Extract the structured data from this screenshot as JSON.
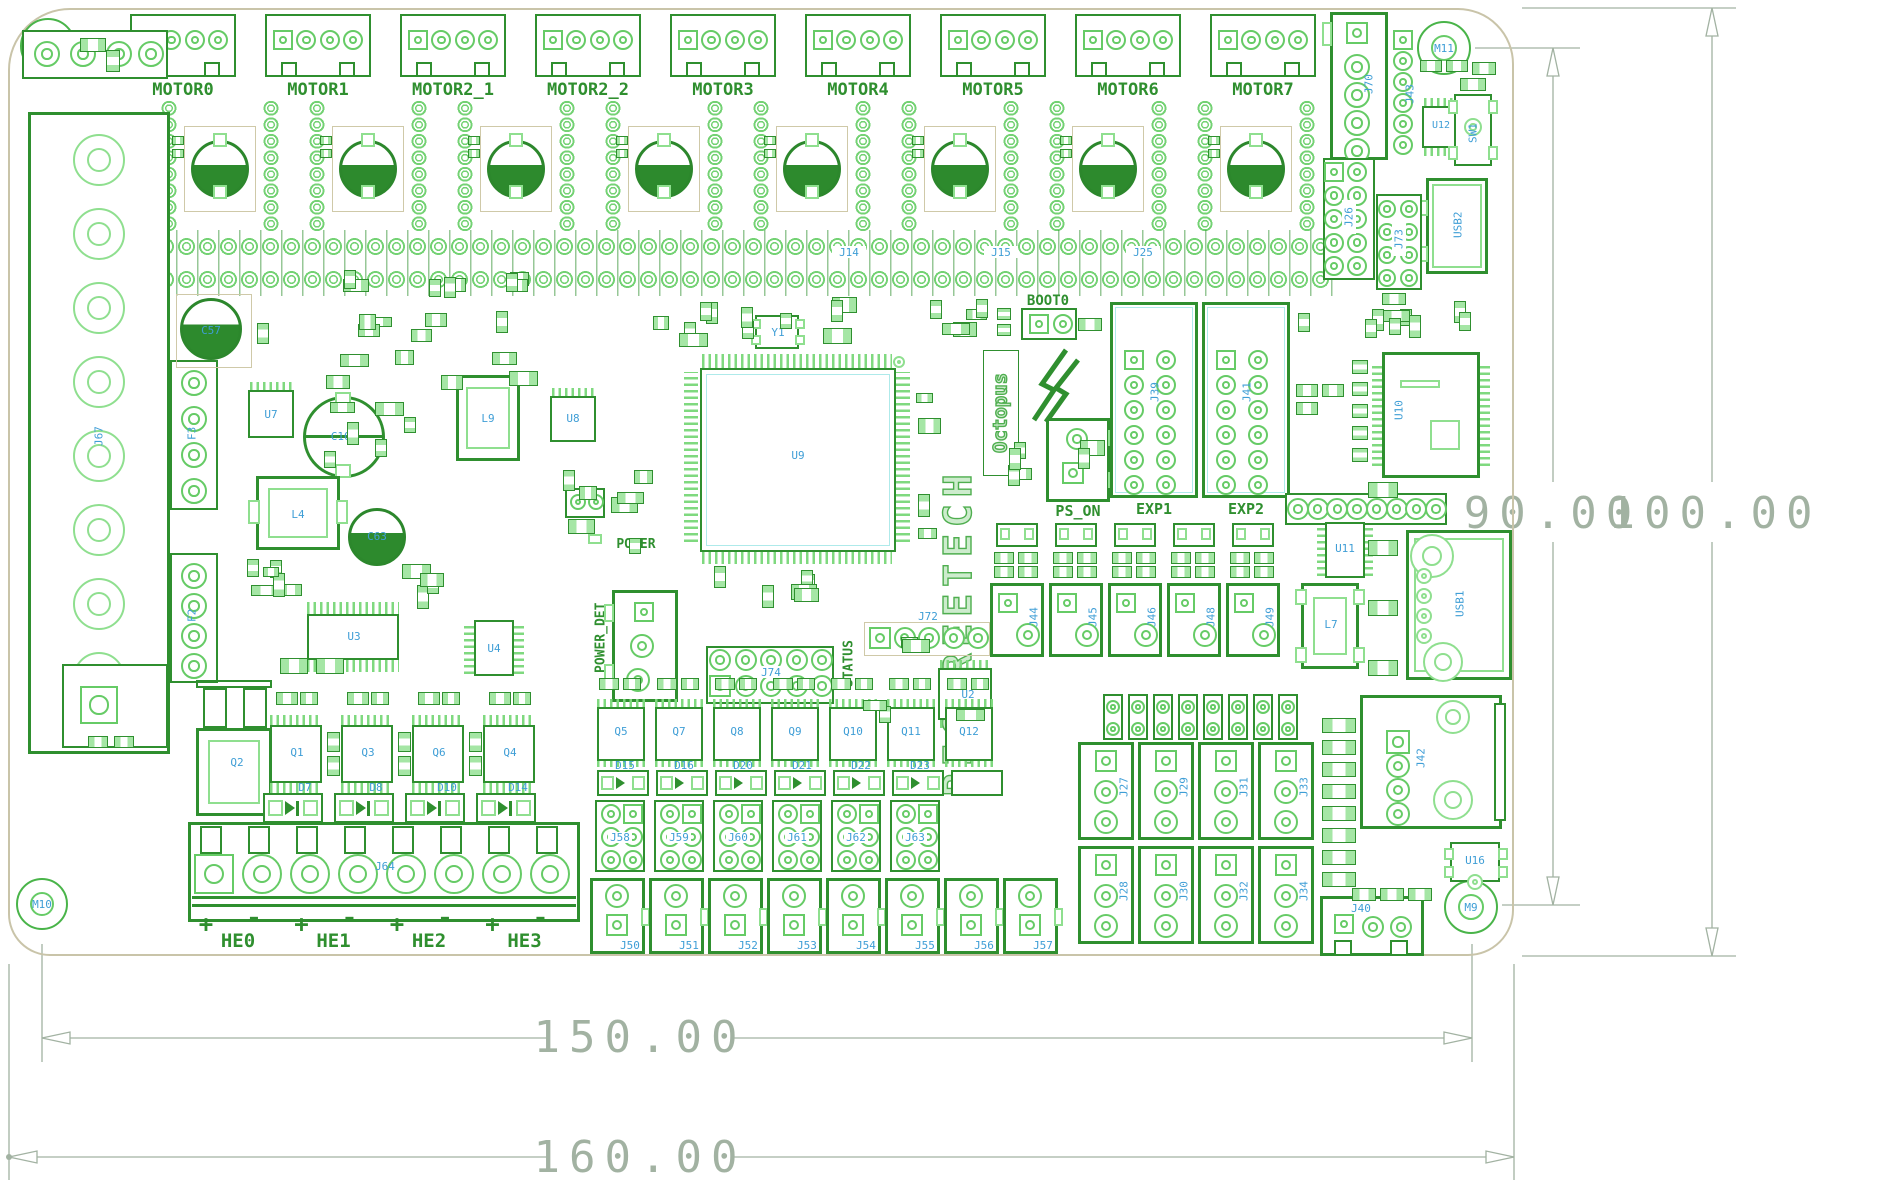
{
  "drawing": {
    "width_inner": "150.00",
    "width_outer": "160.00",
    "height_inner": "90.00",
    "height_outer": "100.00"
  },
  "brand": {
    "name": "BIGTREETECH",
    "product": "Octopus"
  },
  "silk": {
    "boot": "BOOT0",
    "ps_on": "PS_ON",
    "exp1": "EXP1",
    "exp2": "EXP2",
    "power": "POWER",
    "power_det": "POWER_DET",
    "status": "STATUS",
    "plus": "+",
    "minus": "-"
  },
  "motors": {
    "labels": [
      "MOTOR0",
      "MOTOR1",
      "MOTOR2_1",
      "MOTOR2_2",
      "MOTOR3",
      "MOTOR4",
      "MOTOR5",
      "MOTOR6",
      "MOTOR7"
    ]
  },
  "heaters": {
    "labels": [
      "HE0",
      "HE1",
      "HE2",
      "HE3"
    ]
  },
  "refs": {
    "mounting": [
      "M12",
      "M11",
      "M10",
      "M9"
    ],
    "mcu": "U9",
    "crystal": "Y1",
    "fuses": [
      "F1",
      "F3",
      "F2"
    ],
    "power_terminal": "J67",
    "heater_terminal": "J64",
    "capacitors": [
      "C57",
      "C63",
      "C104"
    ],
    "inductors": [
      "L4",
      "L9",
      "L7"
    ],
    "ics": [
      "U2",
      "U3",
      "U4",
      "U7",
      "U8",
      "U10",
      "U11",
      "U12",
      "U16"
    ],
    "usb": [
      "USB2",
      "USB1"
    ],
    "switch": "SW1",
    "headers_right": [
      "J70",
      "J43",
      "J26",
      "J73"
    ],
    "exp_headers": [
      "J39",
      "J41"
    ],
    "driver_rows": [
      "J14",
      "J15",
      "J25"
    ],
    "misc_headers": [
      "J74",
      "J72",
      "J42",
      "J40"
    ],
    "big_transistor": "Q2",
    "heater_mosfets": [
      "Q1",
      "Q3",
      "Q6",
      "Q4"
    ],
    "heater_diodes": [
      "D7",
      "D8",
      "D10",
      "D14"
    ],
    "fan_mosfets": [
      "Q5",
      "Q7",
      "Q8",
      "Q9",
      "Q10",
      "Q11",
      "Q12"
    ],
    "fan_diodes": [
      "D15",
      "D16",
      "D20",
      "D21",
      "D22",
      "D23"
    ],
    "fan_outputs": [
      "J50",
      "J51",
      "J52",
      "J53",
      "J54",
      "J55",
      "J56",
      "J57"
    ],
    "fan_headers": [
      "J58",
      "J59",
      "J60",
      "J61",
      "J62",
      "J63"
    ],
    "endstops_top": [
      "J27",
      "J29",
      "J31",
      "J33"
    ],
    "endstops_bottom": [
      "J28",
      "J30",
      "J32",
      "J34"
    ],
    "thermistors": [
      "J44",
      "J45",
      "J46",
      "J48",
      "J49"
    ]
  }
}
